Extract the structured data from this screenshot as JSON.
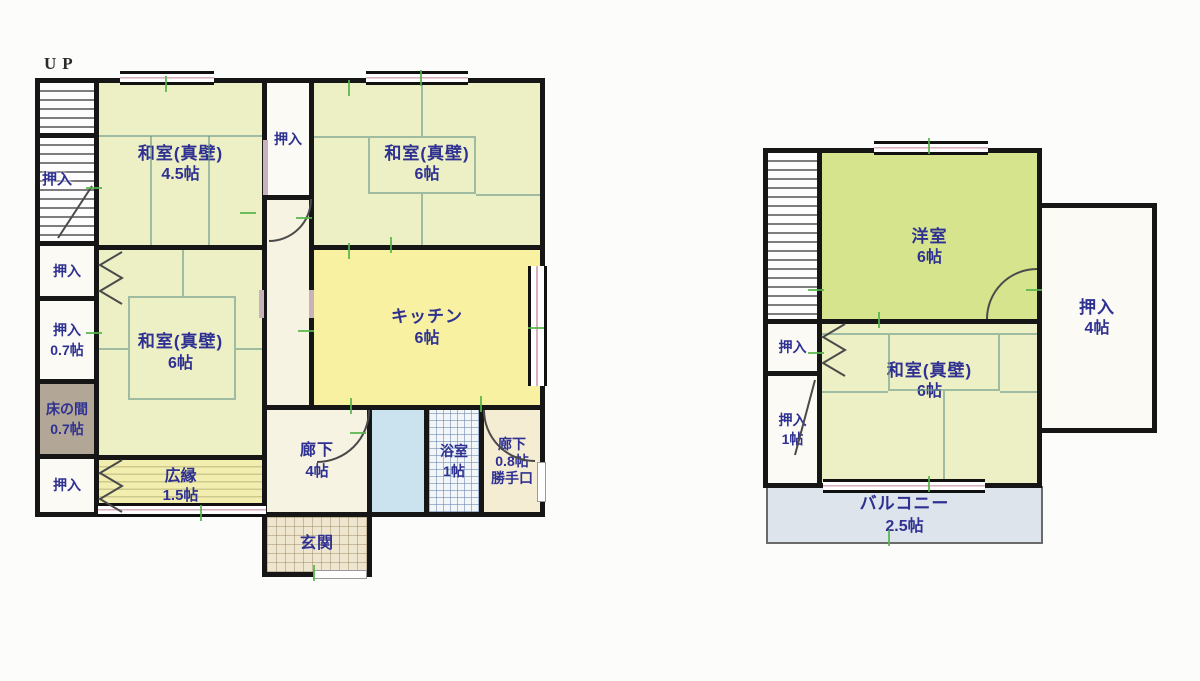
{
  "floor1": {
    "up_label": "UP",
    "rooms": {
      "washitsu_45": {
        "name": "和室(真壁)",
        "size": "4.5帖"
      },
      "oshiire_top": {
        "name": "押入"
      },
      "washitsu_6_top": {
        "name": "和室(真壁)",
        "size": "6帖"
      },
      "washitsu_6_mid": {
        "name": "和室(真壁)",
        "size": "6帖"
      },
      "kitchen": {
        "name": "キッチン",
        "size": "6帖"
      },
      "hiroen": {
        "name": "広縁",
        "size": "1.5帖"
      },
      "rouka": {
        "name": "廊下",
        "size": "4帖"
      },
      "genkan": {
        "name": "玄関"
      },
      "bathroom": {
        "name": "浴室",
        "size": "1帖"
      },
      "rouka_back": {
        "name": "廊下",
        "size": "0.8帖"
      },
      "katteguchi": {
        "name": "勝手口"
      },
      "oshiire_stairs": {
        "name": "押入"
      },
      "oshiire_left_1": {
        "name": "押入"
      },
      "oshiire_left_2": {
        "name": "押入",
        "size": "0.7帖"
      },
      "tokonoma": {
        "name": "床の間",
        "size": "0.7帖"
      },
      "oshiire_left_3": {
        "name": "押入"
      }
    }
  },
  "floor2": {
    "rooms": {
      "youshitsu": {
        "name": "洋室",
        "size": "6帖"
      },
      "washitsu": {
        "name": "和室(真壁)",
        "size": "6帖"
      },
      "oshiire_4": {
        "name": "押入",
        "size": "4帖"
      },
      "oshiire_small": {
        "name": "押入"
      },
      "oshiire_1": {
        "name": "押入",
        "size": "1帖"
      },
      "balcony": {
        "name": "バルコニー",
        "size": "2.5帖"
      }
    }
  },
  "colors": {
    "wall": "#161616",
    "label_text": "#2e3191",
    "tatami_room": "#edefc4",
    "kitchen": "#f7f1a1",
    "western_room": "#d6e48e",
    "tokonoma": "#b2a796",
    "balcony": "#dde4ec",
    "washroom": "#cbe3ef",
    "measure_mark": "#54b44a"
  }
}
